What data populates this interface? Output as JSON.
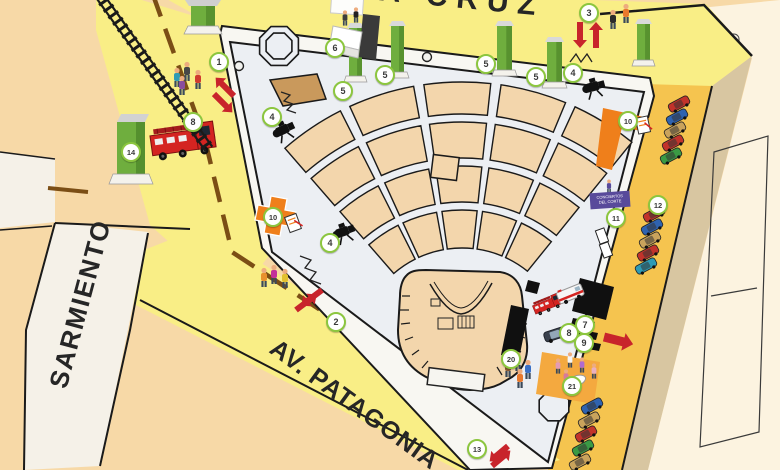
{
  "title": "Festival plaza site map",
  "streets": {
    "top": "SANTA CRUZ",
    "left": "SARMIENTO",
    "bottom": "AV. PATAGONIA"
  },
  "sign": {
    "line1": "CONCIERTOS",
    "line2": "DEL CORTE"
  },
  "colors": {
    "background": "#f7d9a7",
    "street_yellow": "#f9ee86",
    "strip_gold": "#f5c44f",
    "plaza": "#eceff3",
    "seat_tan": "#f3d6ac",
    "accent_red": "#c8242b",
    "accent_orange": "#ef7f1b",
    "kiosk_green": "#6fae3e",
    "marker_ring": "#8cc63f",
    "sign_purple": "#584a9b",
    "median_brown": "#7b4e15",
    "sand": "#d8c6a1",
    "cream": "#fcf3e0"
  },
  "markers": [
    {
      "n": "1",
      "x": 219,
      "y": 62
    },
    {
      "n": "2",
      "x": 336,
      "y": 322
    },
    {
      "n": "3",
      "x": 589,
      "y": 13
    },
    {
      "n": "4",
      "x": 272,
      "y": 117
    },
    {
      "n": "4",
      "x": 330,
      "y": 243
    },
    {
      "n": "4",
      "x": 573,
      "y": 73
    },
    {
      "n": "5",
      "x": 343,
      "y": 91
    },
    {
      "n": "5",
      "x": 385,
      "y": 75
    },
    {
      "n": "5",
      "x": 486,
      "y": 64
    },
    {
      "n": "5",
      "x": 536,
      "y": 77
    },
    {
      "n": "6",
      "x": 335,
      "y": 48
    },
    {
      "n": "7",
      "x": 585,
      "y": 325
    },
    {
      "n": "8",
      "x": 569,
      "y": 333
    },
    {
      "n": "9",
      "x": 584,
      "y": 343
    },
    {
      "n": "8",
      "x": 193,
      "y": 122
    },
    {
      "n": "10",
      "x": 273,
      "y": 217
    },
    {
      "n": "10",
      "x": 628,
      "y": 121
    },
    {
      "n": "11",
      "x": 616,
      "y": 218
    },
    {
      "n": "12",
      "x": 658,
      "y": 205
    },
    {
      "n": "13",
      "x": 477,
      "y": 449
    },
    {
      "n": "14",
      "x": 131,
      "y": 152
    },
    {
      "n": "20",
      "x": 511,
      "y": 359
    },
    {
      "n": "21",
      "x": 572,
      "y": 386
    }
  ],
  "map": {
    "carAngle": -28,
    "pillars": [
      {
        "x": 349,
        "y": 28,
        "w": 13,
        "h": 48
      },
      {
        "x": 391,
        "y": 26,
        "w": 13,
        "h": 46
      },
      {
        "x": 497,
        "y": 26,
        "w": 15,
        "h": 44
      },
      {
        "x": 547,
        "y": 42,
        "w": 15,
        "h": 40
      },
      {
        "x": 637,
        "y": 24,
        "w": 13,
        "h": 36
      }
    ],
    "seating": {
      "cx": 462,
      "cy": 352,
      "a0": -131,
      "a1": -51,
      "cols": 5,
      "gap": 2.2,
      "rows": [
        [
          238,
          270
        ],
        [
          194,
          230
        ],
        [
          150,
          186
        ],
        [
          104,
          142
        ]
      ]
    },
    "cars": [
      {
        "x": 679,
        "y": 104,
        "c": "#c2332b"
      },
      {
        "x": 677,
        "y": 117,
        "c": "#2f63b0"
      },
      {
        "x": 675,
        "y": 130,
        "c": "#c9a35c"
      },
      {
        "x": 673,
        "y": 143,
        "c": "#c2332b"
      },
      {
        "x": 671,
        "y": 156,
        "c": "#3a9a44"
      },
      {
        "x": 654,
        "y": 214,
        "c": "#c2332b"
      },
      {
        "x": 652,
        "y": 227,
        "c": "#2f63b0"
      },
      {
        "x": 650,
        "y": 240,
        "c": "#c9a35c"
      },
      {
        "x": 648,
        "y": 253,
        "c": "#c2332b"
      },
      {
        "x": 646,
        "y": 266,
        "c": "#2e9bb5"
      },
      {
        "x": 592,
        "y": 406,
        "c": "#2f63b0"
      },
      {
        "x": 589,
        "y": 420,
        "c": "#c9a35c"
      },
      {
        "x": 586,
        "y": 434,
        "c": "#c2332b"
      },
      {
        "x": 583,
        "y": 448,
        "c": "#3a9a44"
      },
      {
        "x": 580,
        "y": 462,
        "c": "#c9a35c"
      }
    ],
    "people": [
      {
        "x": 177,
        "y": 80,
        "c": "#2e9bb5"
      },
      {
        "x": 187,
        "y": 74,
        "c": "#474747"
      },
      {
        "x": 198,
        "y": 82,
        "c": "#cf3b2f"
      },
      {
        "x": 182,
        "y": 88,
        "c": "#8a4c9e"
      },
      {
        "x": 345,
        "y": 20,
        "c": "#3d3d3d",
        "s": 0.8
      },
      {
        "x": 356,
        "y": 17,
        "c": "#222222",
        "s": 0.8
      },
      {
        "x": 613,
        "y": 22,
        "c": "#2b2b2b"
      },
      {
        "x": 626,
        "y": 16,
        "c": "#e8792d"
      },
      {
        "x": 264,
        "y": 280,
        "c": "#e8912d"
      },
      {
        "x": 274,
        "y": 277,
        "c": "#c3309a"
      },
      {
        "x": 285,
        "y": 281,
        "c": "#e3c12f"
      },
      {
        "x": 508,
        "y": 370,
        "c": "#8a5a33"
      },
      {
        "x": 518,
        "y": 364,
        "c": "#ececec"
      },
      {
        "x": 528,
        "y": 372,
        "c": "#3a6fc4"
      },
      {
        "x": 520,
        "y": 381,
        "c": "#e8792d"
      },
      {
        "x": 558,
        "y": 368,
        "c": "#e39bb5",
        "s": 0.8
      },
      {
        "x": 570,
        "y": 362,
        "c": "#f5f5f5",
        "s": 0.8
      },
      {
        "x": 582,
        "y": 367,
        "c": "#b06ad0",
        "s": 0.8
      },
      {
        "x": 594,
        "y": 373,
        "c": "#e8b0c0",
        "s": 0.8
      },
      {
        "x": 566,
        "y": 379,
        "c": "#d87a9a",
        "s": 0.8
      },
      {
        "x": 609,
        "y": 188,
        "c": "#584a9b",
        "s": 0.7
      }
    ],
    "cameras": [
      [
        284,
        130,
        -25
      ],
      [
        344,
        232,
        -20
      ],
      [
        594,
        87,
        -15
      ]
    ],
    "arrows": [
      {
        "x": 234,
        "y": 96,
        "a": -135,
        "l": 26
      },
      {
        "x": 214,
        "y": 94,
        "a": 45,
        "l": 26
      },
      {
        "x": 322,
        "y": 290,
        "a": 143,
        "l": 26
      },
      {
        "x": 296,
        "y": 310,
        "a": -37,
        "l": 26
      },
      {
        "x": 580,
        "y": 22,
        "a": 90,
        "l": 26
      },
      {
        "x": 596,
        "y": 48,
        "a": -90,
        "l": 26
      },
      {
        "x": 508,
        "y": 446,
        "a": 140,
        "l": 24
      },
      {
        "x": 492,
        "y": 466,
        "a": -40,
        "l": 24
      },
      {
        "x": 604,
        "y": 337,
        "a": 14,
        "l": 30,
        "big": true
      }
    ],
    "trees": [
      [
        239,
        66
      ],
      [
        210,
        137
      ],
      [
        427,
        57
      ]
    ],
    "octagons": [
      {
        "x": 279,
        "y": 46,
        "r": 21
      },
      {
        "x": 279,
        "y": 46,
        "r": 14
      },
      {
        "x": 554,
        "y": 406,
        "r": 16
      }
    ],
    "track": {
      "x1": 97,
      "y1": -8,
      "x2": 209,
      "y2": 149
    },
    "vehicles": [
      {
        "t": "firetruck",
        "x": 148,
        "y": 122,
        "r": -8,
        "s": 1
      },
      {
        "t": "firetruck",
        "x": 530,
        "y": 300,
        "r": -22,
        "s": 0.45
      },
      {
        "t": "ambulance",
        "x": 556,
        "y": 293,
        "r": -22,
        "s": 1
      },
      {
        "t": "car",
        "x": 543,
        "y": 333,
        "r": -18,
        "s": 1
      }
    ],
    "clipboards": [
      [
        293,
        223,
        -20
      ],
      [
        643,
        125,
        -12
      ]
    ],
    "bays": [
      [
        602,
        236
      ],
      [
        606,
        250
      ]
    ]
  }
}
